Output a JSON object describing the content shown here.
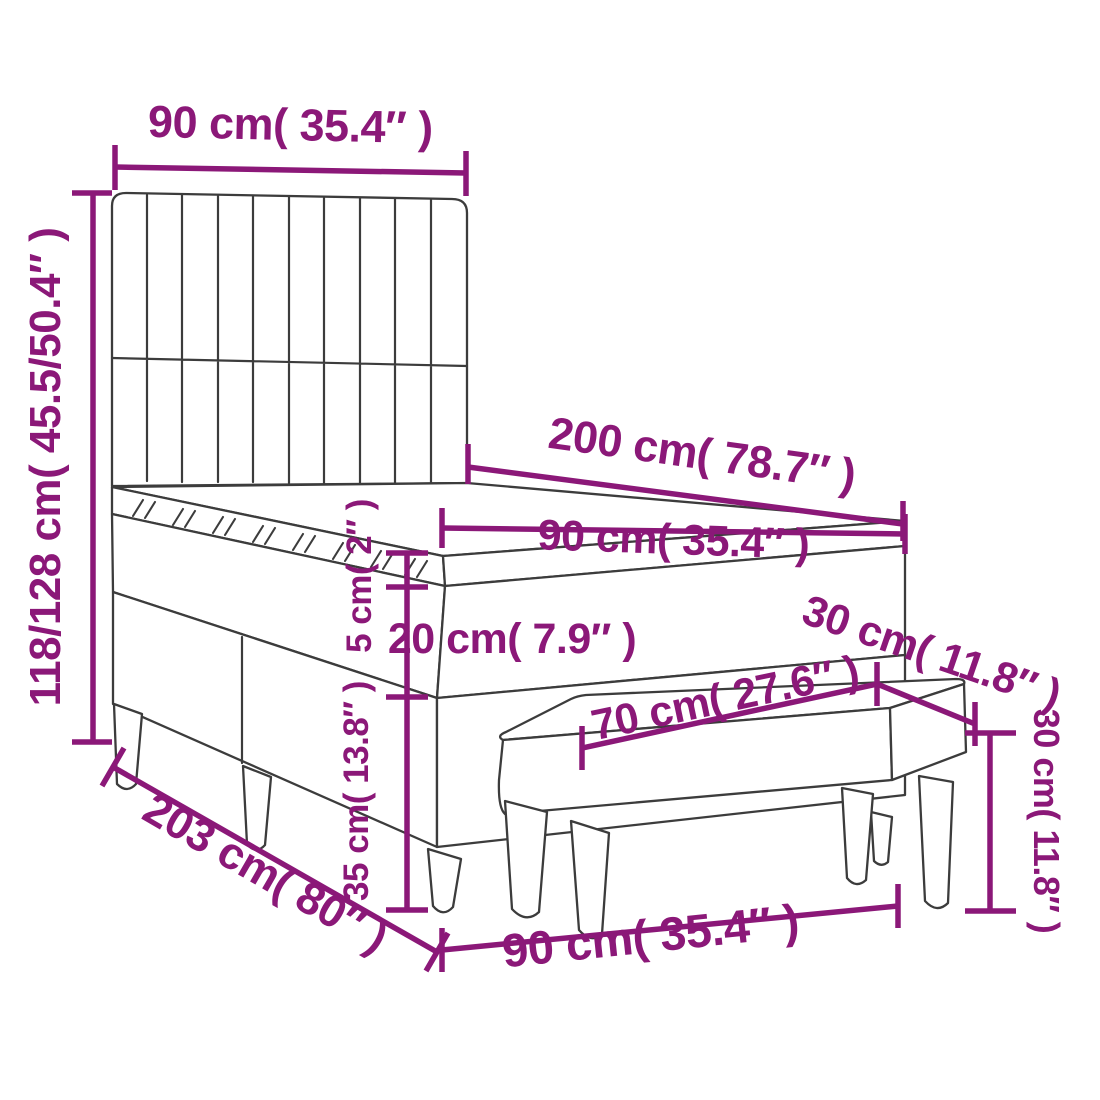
{
  "diagram_title": "Box spring bed with bench dimension diagram",
  "colors": {
    "accent": "#8B1878",
    "line": "#3C3C3C",
    "background": "#FFFFFF"
  },
  "dimensions": {
    "headboard_width": {
      "label": "90 cm( 35.4″ )"
    },
    "overall_height": {
      "label": "118/128 cm( 45.5/50.4″ )"
    },
    "bed_length": {
      "label": "200 cm( 78.7″ )"
    },
    "mattress_width": {
      "label": "90 cm( 35.4″ )"
    },
    "topper_height": {
      "label": "5 cm( 2″ )"
    },
    "mattress_height": {
      "label": "20 cm( 7.9″ )"
    },
    "bench_depth": {
      "label": "30 cm( 11.8″ )"
    },
    "bench_length": {
      "label": "70 cm( 27.6″ )"
    },
    "base_height": {
      "label": "35 cm( 13.8″ )"
    },
    "frame_length": {
      "label": "203 cm( 80″ )"
    },
    "frame_width": {
      "label": "90 cm( 35.4″ )"
    },
    "bench_height": {
      "label": "30 cm( 11.8″ )"
    }
  }
}
